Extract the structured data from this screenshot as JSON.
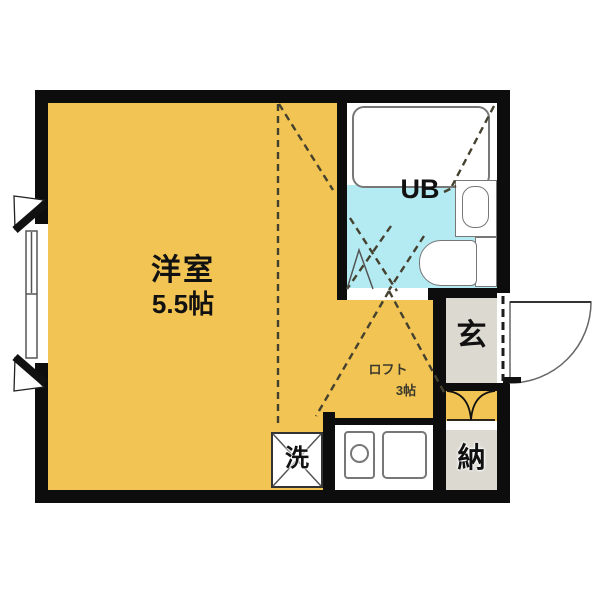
{
  "rooms": {
    "main_room": {
      "name": "洋室",
      "size": "5.5帖"
    },
    "unit_bath": {
      "label": "UB"
    },
    "entrance": {
      "label": "玄"
    },
    "storage": {
      "label": "納"
    },
    "washer": {
      "label": "洗"
    },
    "loft": {
      "name": "ロフト",
      "size": "3帖"
    }
  },
  "colors": {
    "background": "#ffffff",
    "room_fill": "#f1c454",
    "bath_fill": "#b4eaf2",
    "entry_fill": "#dcd9d1",
    "wall": "#0d0d0d",
    "dash": "#45412f",
    "fixture_stroke": "#777777",
    "text": "#111111"
  }
}
